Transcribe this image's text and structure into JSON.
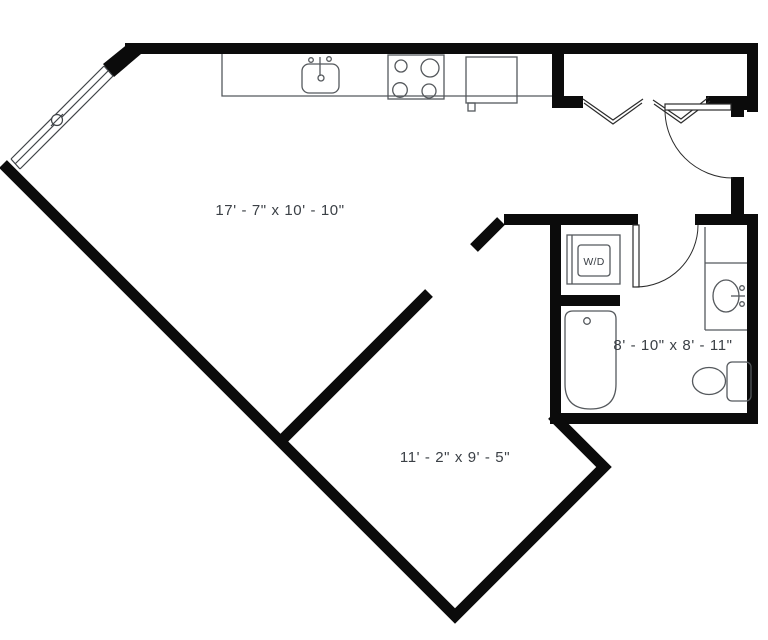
{
  "plan_title": "Studio apartment floor plan",
  "rooms": [
    {
      "id": "living-kitchen",
      "dimensions": "17' - 7\" x 10' - 10\""
    },
    {
      "id": "bedroom",
      "dimensions": "11' - 2\" x 9' - 5\""
    },
    {
      "id": "bathroom",
      "dimensions": "8' - 10\" x 8' - 11\""
    }
  ],
  "appliances": {
    "washer_dryer": "W/D"
  },
  "fixtures": [
    "kitchen-counter",
    "kitchen-sink",
    "stove",
    "refrigerator",
    "washer-dryer",
    "bathtub",
    "vanity-sink",
    "toilet",
    "entry-door",
    "bathroom-door",
    "bifold-closet-doors",
    "window-wall"
  ],
  "colors": {
    "wall": "#0b0b0b",
    "fixture_line": "#55595d",
    "door_line": "#2b2b2b",
    "text": "#3b4046",
    "background": "#ffffff"
  }
}
